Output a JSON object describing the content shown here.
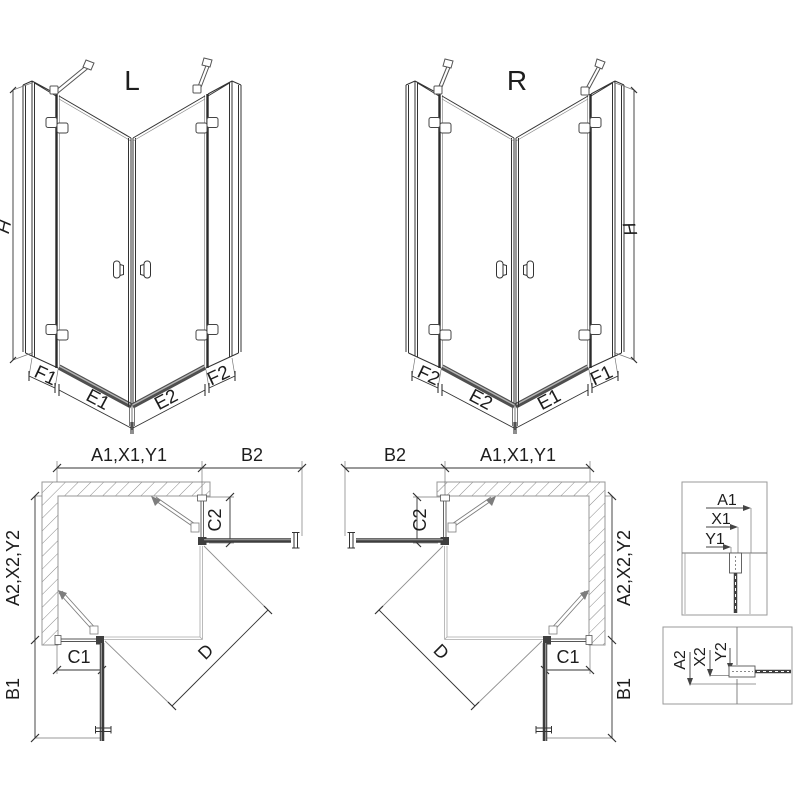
{
  "drawing": {
    "subject": "corner shower enclosure dimension diagram",
    "iso_left": {
      "variant": "L",
      "height": "H",
      "seg_far_left": "F1",
      "seg_left": "E1",
      "seg_right": "E2",
      "seg_far_right": "F2"
    },
    "iso_right": {
      "variant": "R",
      "height": "H",
      "seg_far_left": "F2",
      "seg_left": "E2",
      "seg_right": "E1",
      "seg_far_right": "F1"
    },
    "plan_left": {
      "width_top": "A1,X1,Y1",
      "door_top": "B2",
      "fixed_depth_top": "C2",
      "depth_side": "A2,X2,Y2",
      "fixed_width_bottom": "C1",
      "door_bottom": "B1",
      "entry_diagonal": "D"
    },
    "plan_right": {
      "width_top": "A1,X1,Y1",
      "door_top": "B2",
      "fixed_depth_top": "C2",
      "depth_side": "A2,X2,Y2",
      "fixed_width_bottom": "C1",
      "door_bottom": "B1",
      "entry_diagonal": "D"
    },
    "detail_top": {
      "dim1": "A1",
      "dim2": "X1",
      "dim3": "Y1"
    },
    "detail_bottom": {
      "dim1": "A2",
      "dim2": "X2",
      "dim3": "Y2"
    },
    "colors": {
      "line": "#333333",
      "thick": "#3f3f3f",
      "aux": "#8a8a8a",
      "wall": "#979797",
      "highlight": "#b5b5b5"
    }
  }
}
